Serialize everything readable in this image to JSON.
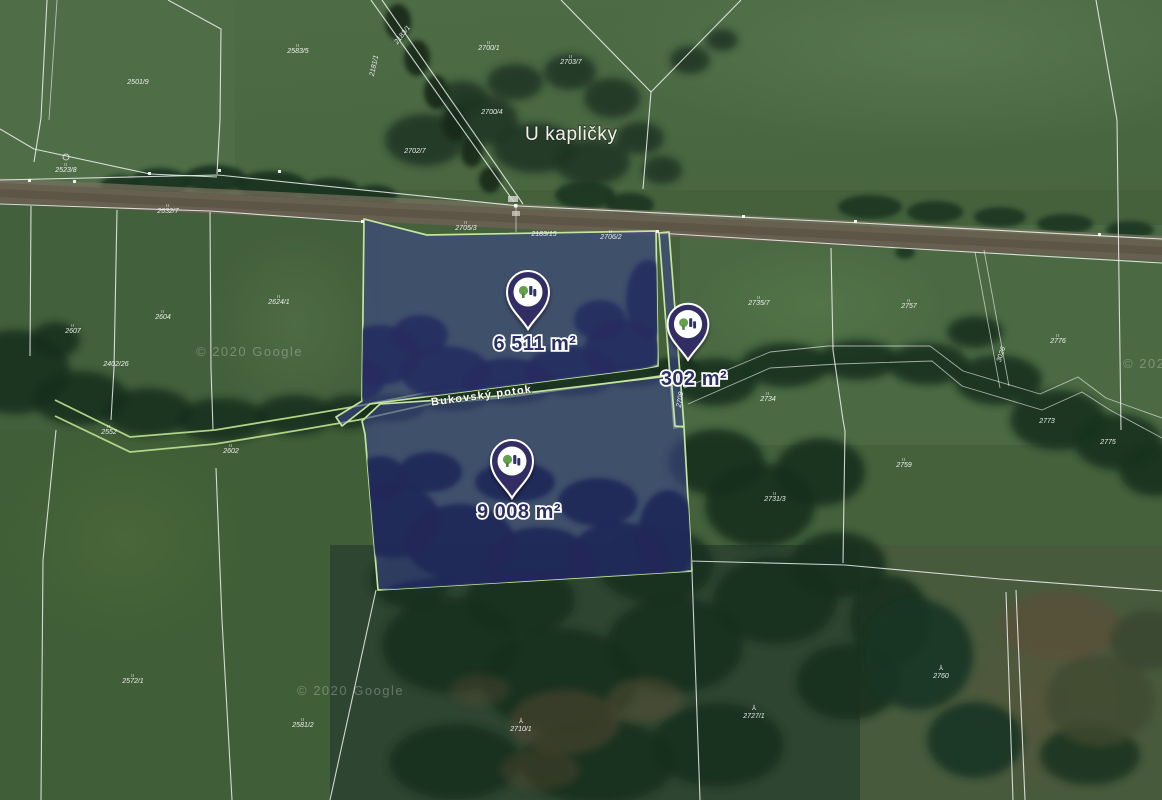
{
  "map": {
    "attribution": "© 2020 Google",
    "place_labels": {
      "locality": "U kapličky",
      "stream": "Bukovský potok"
    },
    "parcels": [
      {
        "id": "upper",
        "area": "6 511 m²"
      },
      {
        "id": "strip",
        "area": "302 m²"
      },
      {
        "id": "lower",
        "area": "9 008 m²"
      }
    ],
    "parcel_numbers": [
      {
        "t": "2501/9",
        "x": 138,
        "y": 84
      },
      {
        "t": "2583/5",
        "x": 298,
        "y": 53,
        "m": 1
      },
      {
        "t": "2181/1",
        "x": 376,
        "y": 66,
        "r": -78
      },
      {
        "t": "2183/1",
        "x": 404,
        "y": 36,
        "r": -52
      },
      {
        "t": "2700/1",
        "x": 489,
        "y": 50,
        "m": 1
      },
      {
        "t": "2703/7",
        "x": 571,
        "y": 64,
        "m": 1
      },
      {
        "t": "2700/4",
        "x": 492,
        "y": 114
      },
      {
        "t": "2702/7",
        "x": 415,
        "y": 153
      },
      {
        "t": "2523/8",
        "x": 66,
        "y": 172,
        "m": 1
      },
      {
        "t": "2632/7",
        "x": 168,
        "y": 213,
        "m": 1
      },
      {
        "t": "2705/3",
        "x": 466,
        "y": 230,
        "m": 1
      },
      {
        "t": "2183/15",
        "x": 544,
        "y": 236
      },
      {
        "t": "2706/2",
        "x": 611,
        "y": 239,
        "m": 1
      },
      {
        "t": "2607",
        "x": 73,
        "y": 333,
        "m": 1
      },
      {
        "t": "2604",
        "x": 163,
        "y": 319,
        "m": 1
      },
      {
        "t": "2624/1",
        "x": 279,
        "y": 304,
        "m": 1
      },
      {
        "t": "2402/26",
        "x": 116,
        "y": 366
      },
      {
        "t": "2552",
        "x": 109,
        "y": 434,
        "m": 1
      },
      {
        "t": "2602",
        "x": 231,
        "y": 453,
        "m": 1
      },
      {
        "t": "2735/7",
        "x": 759,
        "y": 305,
        "m": 1
      },
      {
        "t": "2757",
        "x": 909,
        "y": 308,
        "m": 1
      },
      {
        "t": "2734",
        "x": 768,
        "y": 401,
        "m": 1
      },
      {
        "t": "2776",
        "x": 1058,
        "y": 343,
        "m": 1
      },
      {
        "t": "3026",
        "x": 1003,
        "y": 355,
        "r": -72
      },
      {
        "t": "2708",
        "x": 682,
        "y": 400,
        "r": -80
      },
      {
        "t": "2773",
        "x": 1047,
        "y": 423
      },
      {
        "t": "2775",
        "x": 1108,
        "y": 444
      },
      {
        "t": "2731/3",
        "x": 775,
        "y": 501,
        "m": 1
      },
      {
        "t": "2759",
        "x": 904,
        "y": 467,
        "m": 1
      },
      {
        "t": "2572/1",
        "x": 133,
        "y": 683,
        "m": 1
      },
      {
        "t": "2581/2",
        "x": 303,
        "y": 727,
        "m": 1
      },
      {
        "t": "2710/1",
        "x": 521,
        "y": 731,
        "tr": 1
      },
      {
        "t": "2727/1",
        "x": 754,
        "y": 718,
        "tr": 1
      },
      {
        "t": "2760",
        "x": 941,
        "y": 678,
        "tr": 1
      }
    ],
    "watermarks": [
      {
        "x": 196,
        "y": 356
      },
      {
        "x": 297,
        "y": 695
      },
      {
        "x": 1123,
        "y": 368
      }
    ],
    "colors": {
      "parcel_fill": "rgba(60,68,138,0.6)",
      "parcel_border": "#c3e59c",
      "pin_body": "#332e63",
      "pin_icon_green": "#63a14d",
      "pin_icon_navy": "#2f3364",
      "area_label": "#2b2f63",
      "stream_line": "#b7db8c",
      "boundary_line": "#ffffff"
    }
  }
}
